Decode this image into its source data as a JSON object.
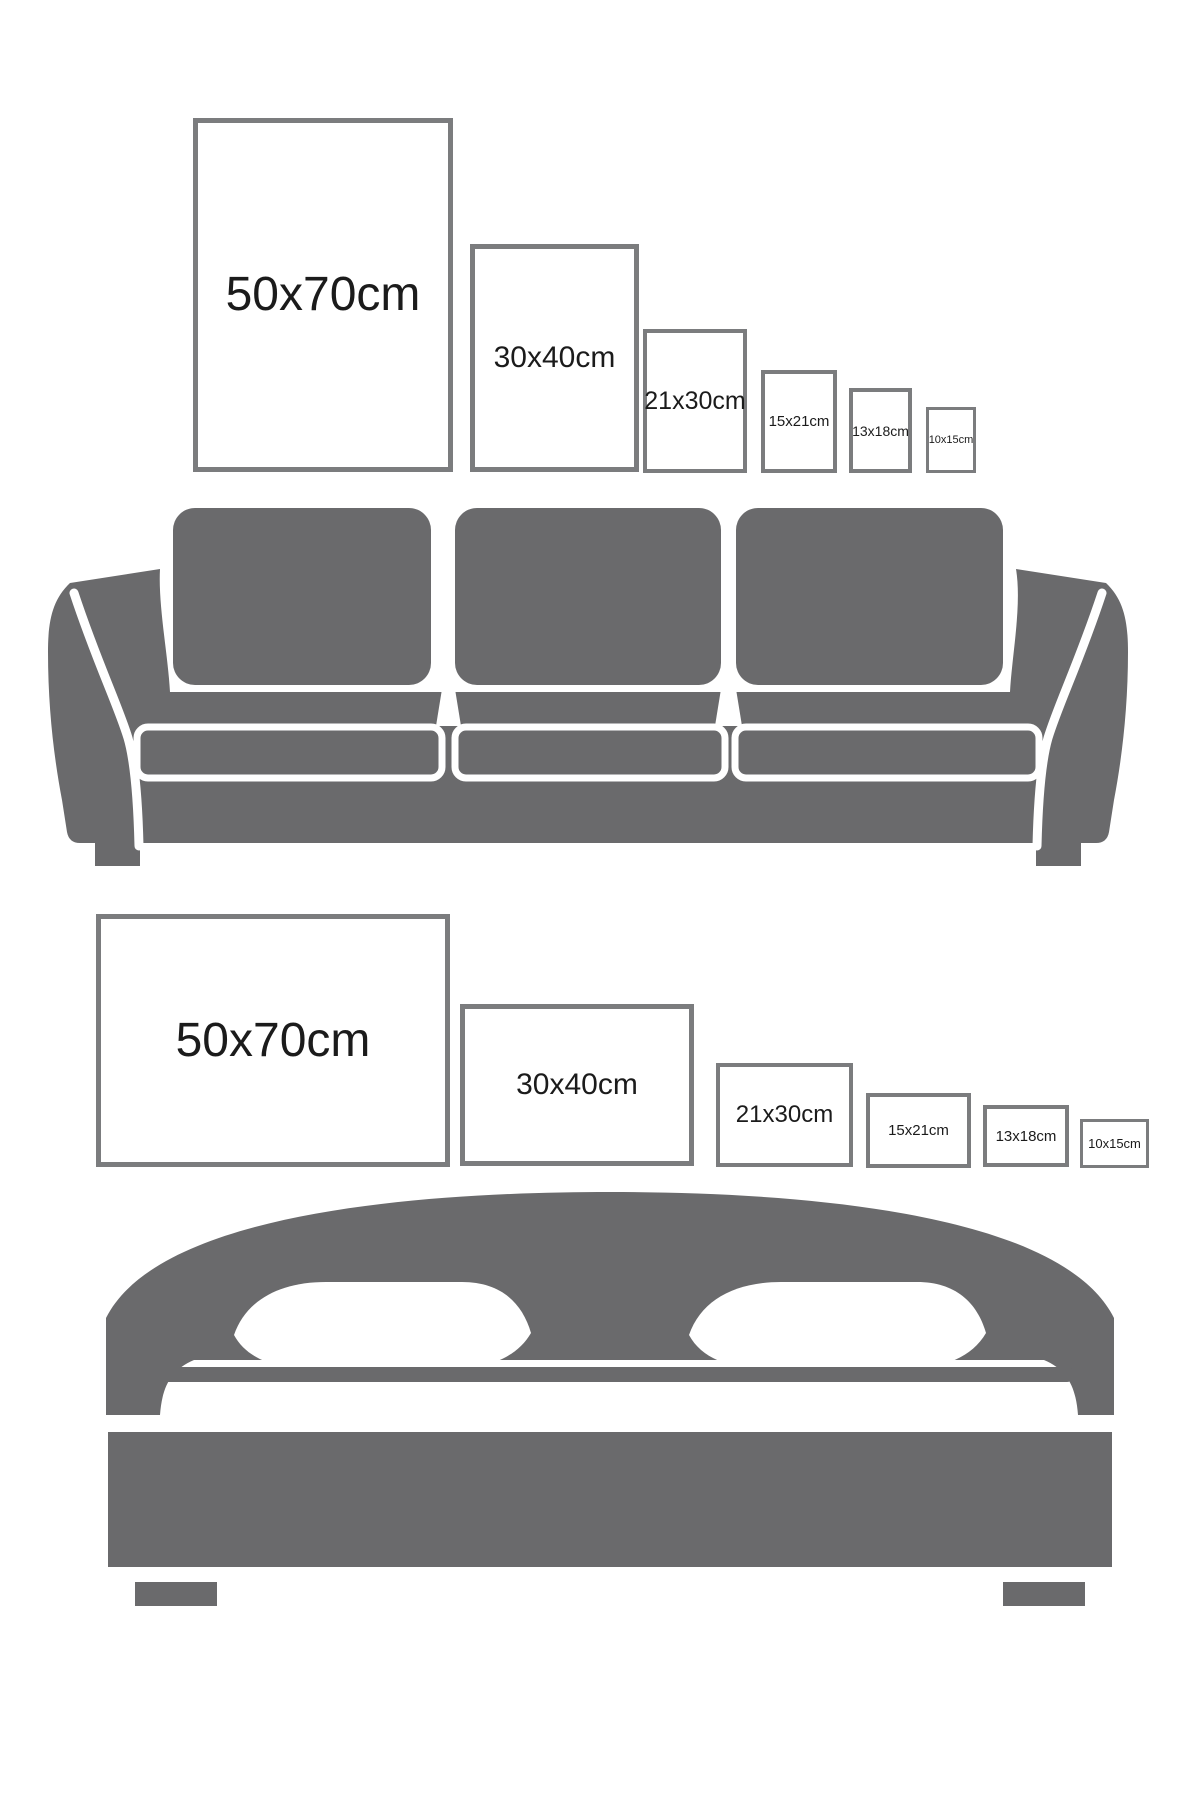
{
  "colors": {
    "background": "#ffffff",
    "furniture": "#6a6a6c",
    "frame_border": "#7b7c7e",
    "label_text": "#1b1b1b"
  },
  "rows": [
    {
      "name": "portrait-frames-above-sofa",
      "furniture": "sofa",
      "frames": [
        {
          "label": "50x70cm",
          "x": 193,
          "y": 118,
          "w": 260,
          "h": 354,
          "font": 48,
          "border": 5
        },
        {
          "label": "30x40cm",
          "x": 470,
          "y": 244,
          "w": 169,
          "h": 228,
          "font": 30,
          "border": 5
        },
        {
          "label": "21x30cm",
          "x": 643,
          "y": 329,
          "w": 104,
          "h": 144,
          "font": 25,
          "border": 4
        },
        {
          "label": "15x21cm",
          "x": 761,
          "y": 370,
          "w": 76,
          "h": 103,
          "font": 15,
          "border": 4
        },
        {
          "label": "13x18cm",
          "x": 849,
          "y": 388,
          "w": 63,
          "h": 85,
          "font": 14,
          "border": 4
        },
        {
          "label": "10x15cm",
          "x": 926,
          "y": 407,
          "w": 50,
          "h": 66,
          "font": 11,
          "border": 3
        }
      ]
    },
    {
      "name": "landscape-frames-above-bed",
      "furniture": "bed",
      "frames": [
        {
          "label": "50x70cm",
          "x": 96,
          "y": 914,
          "w": 354,
          "h": 253,
          "font": 48,
          "border": 5
        },
        {
          "label": "30x40cm",
          "x": 460,
          "y": 1004,
          "w": 234,
          "h": 162,
          "font": 30,
          "border": 5
        },
        {
          "label": "21x30cm",
          "x": 716,
          "y": 1063,
          "w": 137,
          "h": 104,
          "font": 24,
          "border": 4
        },
        {
          "label": "15x21cm",
          "x": 866,
          "y": 1093,
          "w": 105,
          "h": 75,
          "font": 15,
          "border": 4
        },
        {
          "label": "13x18cm",
          "x": 983,
          "y": 1105,
          "w": 86,
          "h": 62,
          "font": 15,
          "border": 4
        },
        {
          "label": "10x15cm",
          "x": 1080,
          "y": 1119,
          "w": 69,
          "h": 49,
          "font": 13,
          "border": 3
        }
      ]
    }
  ]
}
